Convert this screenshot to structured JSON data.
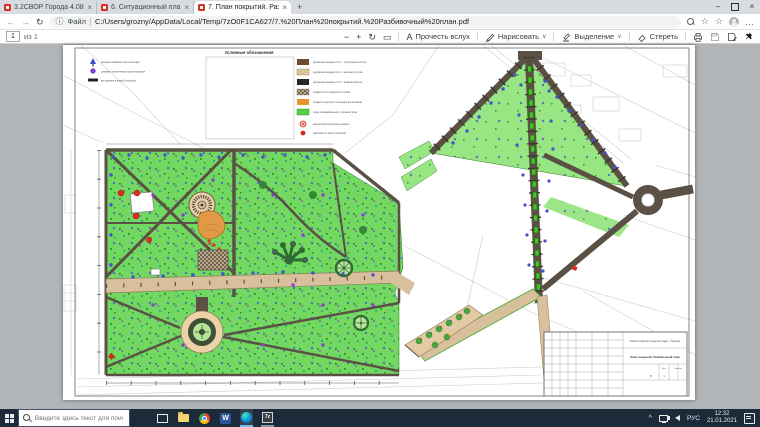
{
  "glyphs": {
    "close": "×",
    "minimize": "–",
    "new_tab": "+",
    "back": "←",
    "forward": "→",
    "reload": "↻",
    "info": "ⓘ",
    "star": "☆",
    "star_add": "☆",
    "more": "…",
    "zoom_out": "−",
    "zoom_in": "+",
    "rotate": "↻",
    "fit": "▭",
    "read_aloud_icon": "А",
    "chevron_down": "∨",
    "tray_expand": "^"
  },
  "browser": {
    "tabs": [
      {
        "title": "3.2СВОР Города 4.08.pdf"
      },
      {
        "title": "6. Ситуационный план.pdf"
      },
      {
        "title": "7. План покрытий. Разбивочн..."
      }
    ],
    "address": {
      "scheme_label": "Файл",
      "url": "C:/Users/grozny/AppData/Local/Temp/7zO0F1CA627/7.%20План%20покрытий.%20Разбивочный%20план.pdf"
    }
  },
  "pdf_toolbar": {
    "page_current": "1",
    "page_total_label": "из 1",
    "read_aloud_label": "Прочесть вслух",
    "draw_label": "Нарисовать",
    "highlight_label": "Выделение",
    "erase_label": "Стереть"
  },
  "plan": {
    "legend_title": "Условные обозначения",
    "legend_trees": [
      {
        "label": "деревья хвойные (ель колючая)"
      },
      {
        "label": "деревья лиственные существующие"
      },
      {
        "label": "кустарники в живой изгороди"
      }
    ],
    "legend_surfaces": [
      {
        "label": "дорожная одежда тип 1 - тротуарная плитка"
      },
      {
        "label": "дорожная одежда тип 2 - цветная плитка"
      },
      {
        "label": "дорожная одежда тип 3 - асфальтобетон"
      },
      {
        "label": "покрытие из гранитного отсева"
      },
      {
        "label": "покрытие детских площадок (резиновое)"
      },
      {
        "label": "газон обыкновенный с посевом трав"
      },
      {
        "label": "малые архитектурные формы"
      },
      {
        "label": "цветники из многолетников"
      }
    ],
    "titleblock": {
      "project": "Благоустройство городского сада, г. Грозный",
      "sheet_title": "План покрытий. Разбивочный план",
      "stage": "П",
      "sheet_label": "Лист",
      "sheets_label": "Листов",
      "sheet_no": "1"
    }
  },
  "taskbar": {
    "search_placeholder": "Введите здесь текст для поиска",
    "language": "РУС",
    "time": "12:32",
    "date": "21.01.2021",
    "word_letter": "W",
    "zip_label": "7z"
  }
}
